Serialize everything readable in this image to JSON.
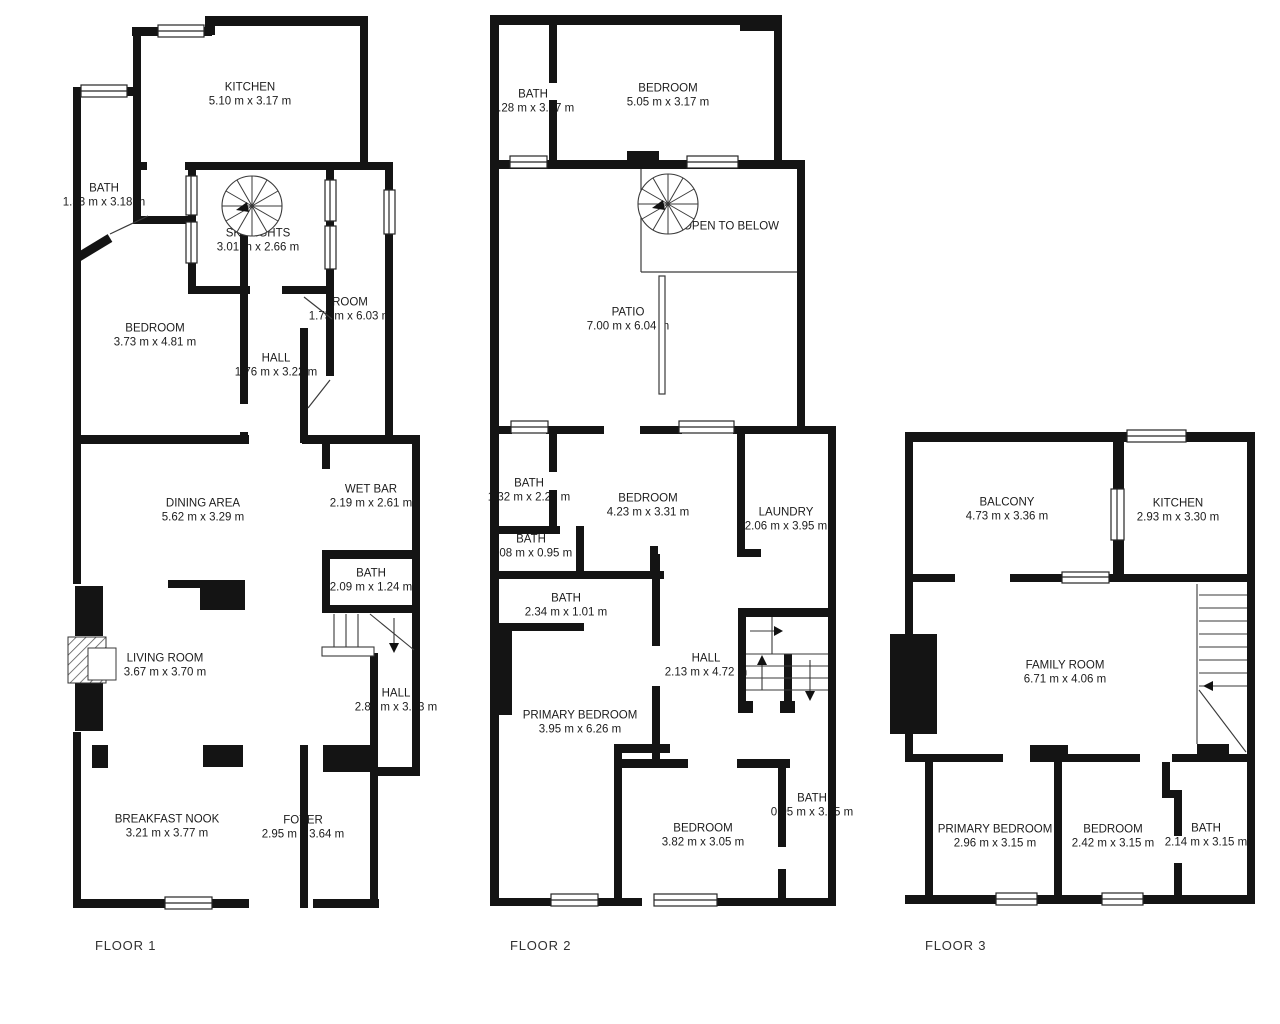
{
  "colors": {
    "walls": "#141414",
    "thin_lines": "#3a3a3a",
    "text": "#1c1c1c",
    "background": "#ffffff"
  },
  "floors": [
    {
      "title": "FLOOR 1",
      "rooms": [
        {
          "name": "KITCHEN",
          "dims": "5.10 m x 3.17 m"
        },
        {
          "name": "BATH",
          "dims": "1.33 m x 3.18 m"
        },
        {
          "name": "SKYLIGHTS",
          "dims": "3.01 m x 2.66 m"
        },
        {
          "name": "BEDROOM",
          "dims": "3.73 m x 4.81 m"
        },
        {
          "name": "HALL",
          "dims": "1.76 m x 3.22 m"
        },
        {
          "name": "ROOM",
          "dims": "1.75 m x 6.03 m"
        },
        {
          "name": "DINING AREA",
          "dims": "5.62 m x 3.29 m"
        },
        {
          "name": "WET BAR",
          "dims": "2.19 m x 2.61 m"
        },
        {
          "name": "BATH",
          "dims": "2.09 m x 1.24 m"
        },
        {
          "name": "LIVING ROOM",
          "dims": "3.67 m x 3.70 m"
        },
        {
          "name": "HALL",
          "dims": "2.84 m x 3.83 m"
        },
        {
          "name": "BREAKFAST NOOK",
          "dims": "3.21 m x 3.77 m"
        },
        {
          "name": "FOYER",
          "dims": "2.95 m x 3.64 m"
        }
      ]
    },
    {
      "title": "FLOOR 2",
      "rooms": [
        {
          "name": "BATH",
          "dims": "1.28 m x 3.17 m"
        },
        {
          "name": "BEDROOM",
          "dims": "5.05 m x 3.17 m"
        },
        {
          "name": "OPEN TO BELOW",
          "dims": ""
        },
        {
          "name": "PATIO",
          "dims": "7.00 m x 6.04 m"
        },
        {
          "name": "BATH",
          "dims": "1.32 m x 2.26 m"
        },
        {
          "name": "BEDROOM",
          "dims": "4.23 m x 3.31 m"
        },
        {
          "name": "LAUNDRY",
          "dims": "2.06 m x 3.95 m"
        },
        {
          "name": "BATH",
          "dims": "2.08 m x 0.95 m"
        },
        {
          "name": "BATH",
          "dims": "2.34 m x 1.01 m"
        },
        {
          "name": "HALL",
          "dims": "2.13 m x 4.72 m"
        },
        {
          "name": "PRIMARY BEDROOM",
          "dims": "3.95 m x 6.26 m"
        },
        {
          "name": "BEDROOM",
          "dims": "3.82 m x 3.05 m"
        },
        {
          "name": "BATH",
          "dims": "0.95 m x 3.05 m"
        }
      ]
    },
    {
      "title": "FLOOR 3",
      "rooms": [
        {
          "name": "BALCONY",
          "dims": "4.73 m x 3.36 m"
        },
        {
          "name": "KITCHEN",
          "dims": "2.93 m x 3.30 m"
        },
        {
          "name": "FAMILY ROOM",
          "dims": "6.71 m x 4.06 m"
        },
        {
          "name": "PRIMARY BEDROOM",
          "dims": "2.96 m x 3.15 m"
        },
        {
          "name": "BEDROOM",
          "dims": "2.42 m x 3.15 m"
        },
        {
          "name": "BATH",
          "dims": "2.14 m x 3.15 m"
        }
      ]
    }
  ]
}
